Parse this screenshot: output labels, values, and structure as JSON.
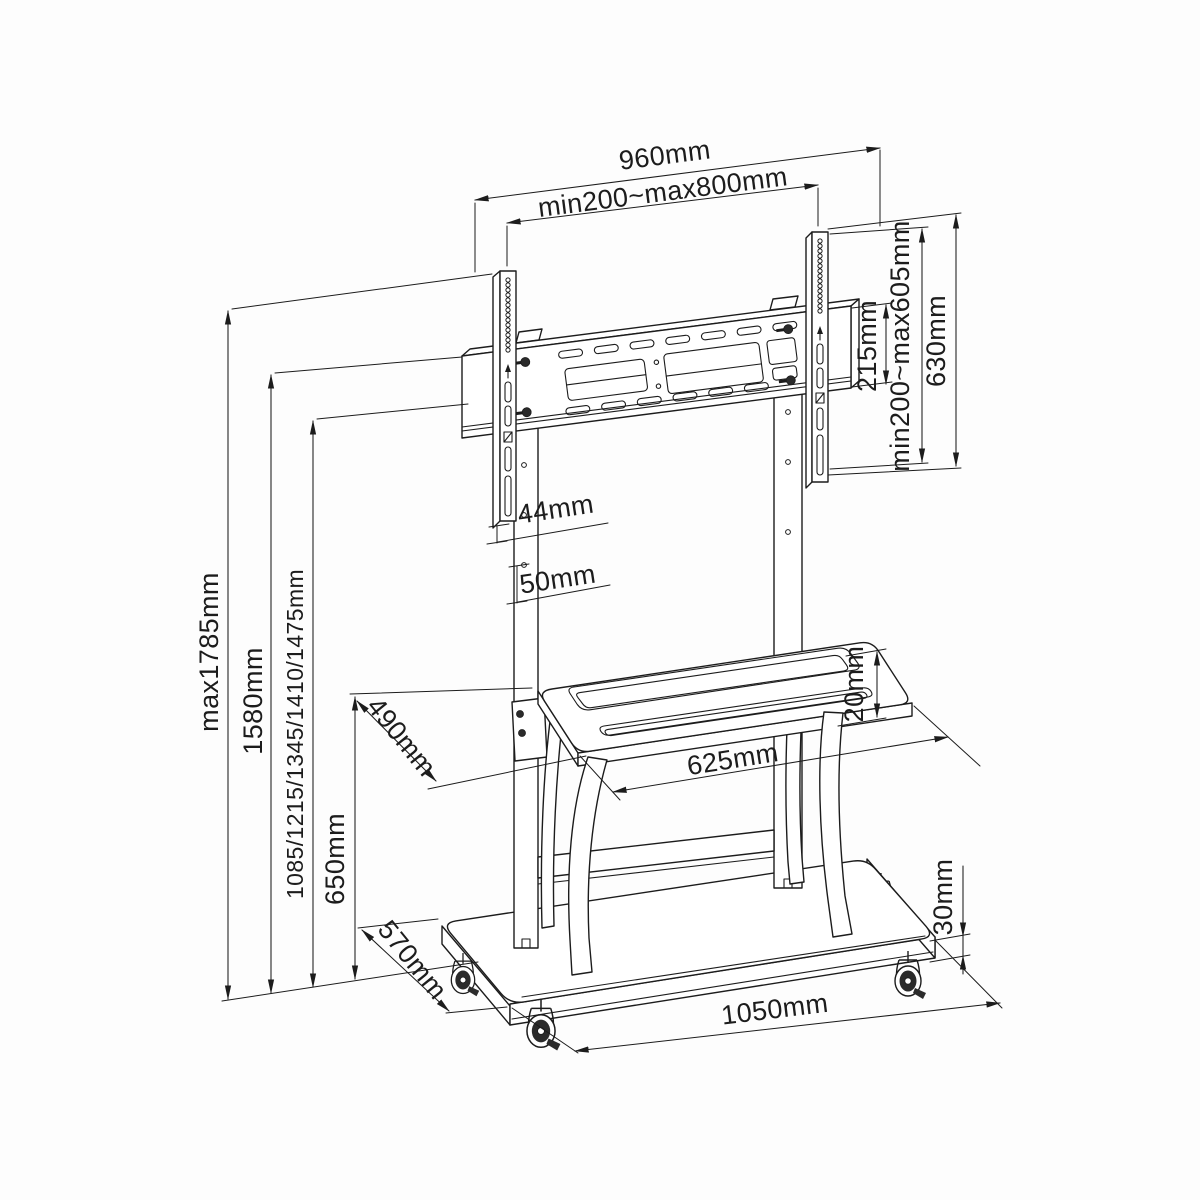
{
  "canvas": {
    "width": 1200,
    "height": 1200,
    "background": "#fdfdfd",
    "line_color": "#1c1c1c",
    "kind": "technical dimensional line drawing of a mobile TV trolley stand"
  },
  "dims": {
    "bracket_width": "960mm",
    "vesa_width_range": "min200~max800mm",
    "bracket_hole_spacing": "215mm",
    "vesa_height_range": "min200~max605mm",
    "rail_height": "630mm",
    "max_total_height": "max1785mm",
    "bracket_top_height": "1580mm",
    "height_positions": "1085/1215/1345/1410/1475mm",
    "shelf_height": "650mm",
    "rail_offset": "44mm",
    "hole_pitch": "50mm",
    "shelf_depth": "490mm",
    "shelf_width": "625mm",
    "shelf_thickness": "20mm",
    "base_thickness": "30mm",
    "base_depth": "570mm",
    "base_width": "1050mm"
  }
}
